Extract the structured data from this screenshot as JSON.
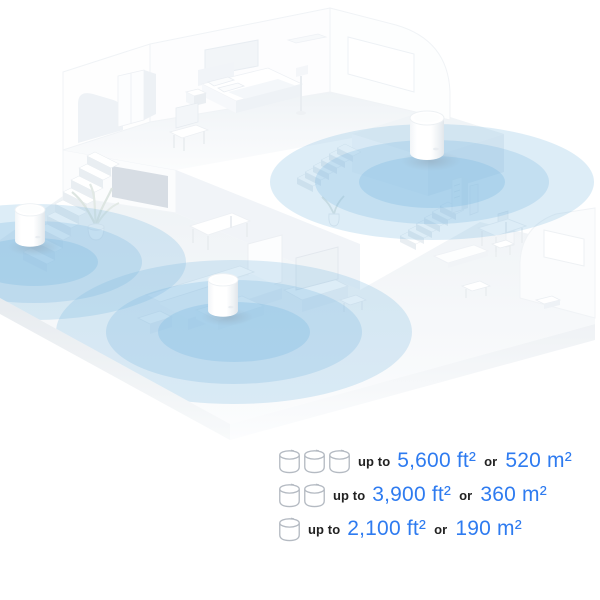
{
  "illustration": {
    "description": "Isometric two-story home floor plan with three mesh Wi-Fi units broadcasting blue coverage circles",
    "device_count": 3,
    "colors": {
      "coverage_blue": "#7cb8e2",
      "wall_white": "#ffffff",
      "wall_shade": "#eef2f6",
      "floor_shade": "#f2f5f8",
      "doorway_shade": "#d7dde4"
    }
  },
  "legend": {
    "rows": [
      {
        "units": 3,
        "up_to": "up to",
        "imperial": "5,600 ft²",
        "or": "or",
        "metric": "520 m²"
      },
      {
        "units": 2,
        "up_to": "up to",
        "imperial": "3,900 ft²",
        "or": "or",
        "metric": "360 m²"
      },
      {
        "units": 1,
        "up_to": "up to",
        "imperial": "2,100 ft²",
        "or": "or",
        "metric": "190 m²"
      }
    ],
    "colors": {
      "accent_blue": "#2e7bf0",
      "text_dark": "#222222",
      "icon_outline": "#b4bac2"
    }
  }
}
